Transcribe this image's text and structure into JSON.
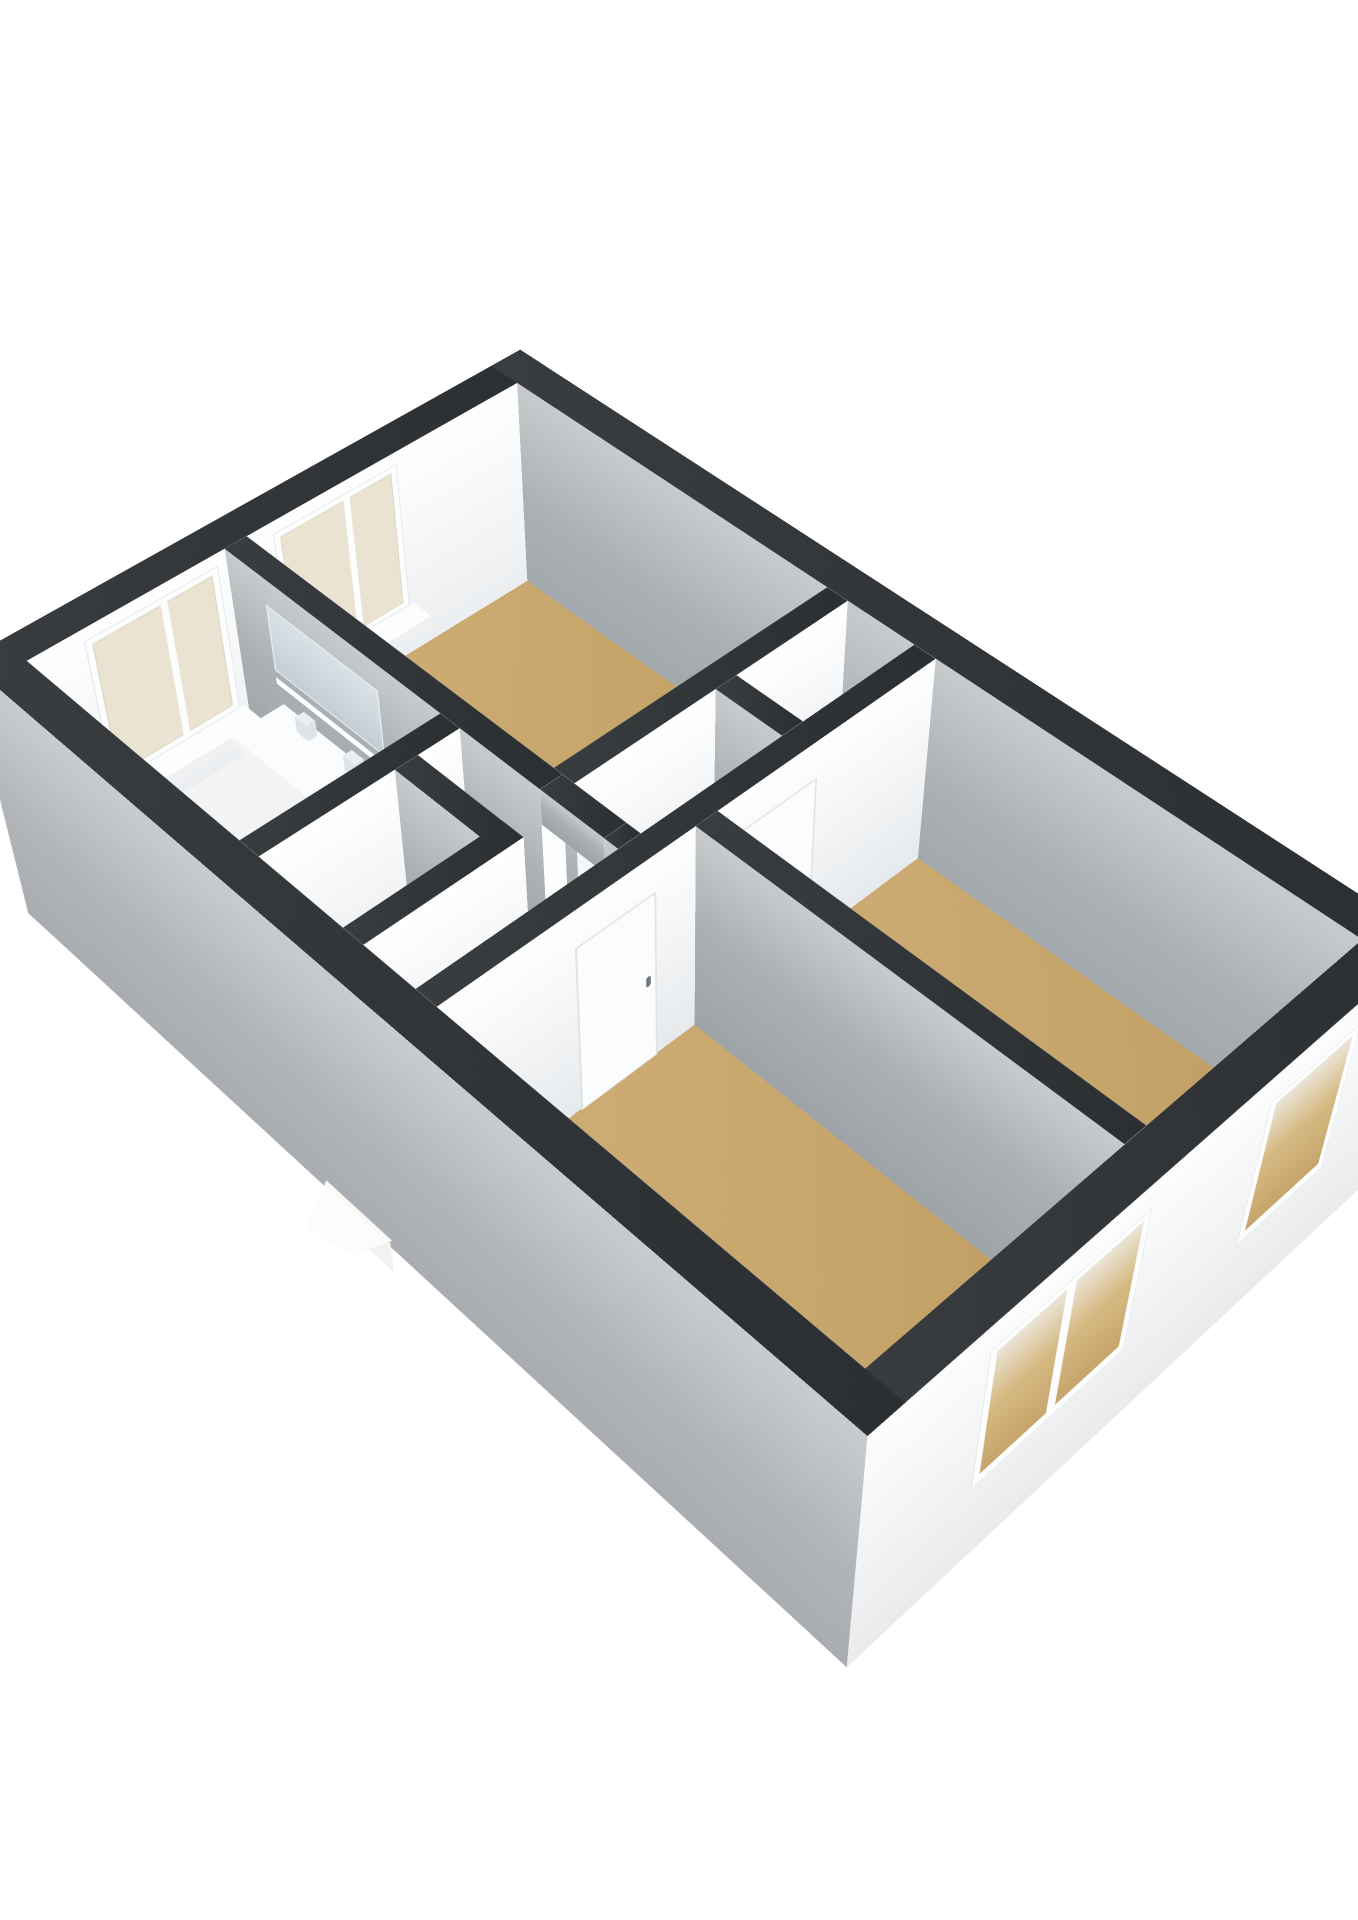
{
  "meta": {
    "kind": "3d-floorplan-render",
    "background": "#ffffff",
    "visible_text": ""
  },
  "palette": {
    "capDark": "linear-gradient(135deg,#3a3d40 0%,#2c2f32 100%)",
    "grayFace": "linear-gradient(180deg,#c7cbce 0%,#abb0b4 45%,#9ea3a7 100%)",
    "whiteFace": "linear-gradient(180deg,#ffffff 0%,#f1f3f5 55%,#e7eaec 100%)",
    "midFace": "#d5d9dc",
    "extWhite": "linear-gradient(180deg,#fdfdfe 0%,#f0f2f3 60%,#e9ebed 100%)",
    "extGray": "linear-gradient(180deg,#c9cccf 0%,#b2b5b8 55%,#a9acb0 100%)",
    "floorTan": "linear-gradient(135deg,#d0af77 0%,#c7a66c 60%,#bf9d62 100%)",
    "floorWhite": "linear-gradient(135deg,#f4f5f6 0%,#eceeef 100%)",
    "cream": "#ebe3d1",
    "frameWhite": "#fcfdfd",
    "mirror": "linear-gradient(180deg,#d8e1e6 0%,#c3ced5 100%)",
    "glassTan": "linear-gradient(180deg,#eae4d6 0%,#d6b982 45%,#c6a46c 100%)",
    "accentRed": "#cf7b7b",
    "leaf": "#fbfcfd",
    "leafEdge": "#dfe2e4",
    "handle": "#71767a"
  },
  "projection": {
    "perspective": 2800,
    "originX": "50%",
    "originY": "43%",
    "rotateX": 44,
    "rotateZ": -44,
    "scale": 1.13,
    "translate": [
      15,
      860
    ],
    "wallHeight": 240,
    "exteriorBase": -70
  },
  "building": {
    "floors": [
      {
        "name": "floor-hall-and-wet-rooms",
        "rect": [
          36,
          36,
          576,
          984
        ],
        "z": 0,
        "fill": "floorWhite"
      },
      {
        "name": "floor-bedroom-north",
        "rect": [
          264,
          36,
          576,
          430
        ],
        "z": 0.8,
        "fill": "floorTan"
      },
      {
        "name": "floor-room-front",
        "rect": [
          36,
          554,
          300,
          984
        ],
        "z": 0.8,
        "fill": "floorTan"
      },
      {
        "name": "floor-room-back",
        "rect": [
          324,
          554,
          576,
          984
        ],
        "z": 0.8,
        "fill": "floorTan"
      }
    ],
    "walls": [
      {
        "name": "exterior-wall-northwest",
        "rect": [
          0,
          0,
          612,
          36
        ],
        "z": [
          -70,
          240
        ],
        "faces": {
          "a0": "extGray",
          "a1": "extWhite",
          "b0": "extWhite",
          "b1": "whiteFace"
        }
      },
      {
        "name": "exterior-wall-northeast",
        "rect": [
          576,
          0,
          612,
          1020
        ],
        "z": [
          -70,
          240
        ],
        "faces": {
          "a0": "grayFace",
          "a1": "extWhite",
          "b0": "midFace",
          "b1": "extWhite"
        }
      },
      {
        "name": "exterior-wall-southeast",
        "rect": [
          0,
          984,
          612,
          1020
        ],
        "z": [
          -70,
          240
        ],
        "faces": {
          "a0": "extGray",
          "a1": "extWhite",
          "b0": "midFace",
          "b1": "extWhite"
        }
      },
      {
        "name": "exterior-wall-southwest",
        "rect": [
          0,
          0,
          36,
          1020
        ],
        "z": [
          -70,
          240
        ],
        "faces": {
          "a0": "extGray",
          "a1": "whiteFace",
          "b0": "extWhite",
          "b1": "extWhite"
        }
      },
      {
        "name": "wall-bathroom-east-a",
        "rect": [
          240,
          36,
          264,
          440
        ],
        "z": [
          0,
          240
        ]
      },
      {
        "name": "wall-bathroom-east-b",
        "rect": [
          240,
          514,
          264,
          530
        ],
        "z": [
          0,
          240
        ]
      },
      {
        "name": "wall-doorway-lintel",
        "rect": [
          240,
          440,
          264,
          514
        ],
        "z": [
          200,
          240
        ],
        "faces": {
          "b0": "whiteFace",
          "b1": "whiteFace"
        }
      },
      {
        "name": "wall-bathroom-south",
        "rect": [
          36,
          320,
          240,
          344
        ],
        "z": [
          0,
          240
        ]
      },
      {
        "name": "wall-wc-south",
        "rect": [
          36,
          446,
          196,
          470
        ],
        "z": [
          0,
          240
        ]
      },
      {
        "name": "wall-wc-east",
        "rect": [
          172,
          344,
          196,
          470
        ],
        "z": [
          0,
          240
        ]
      },
      {
        "name": "wall-bedroom-north-south",
        "rect": [
          264,
          430,
          576,
          454
        ],
        "z": [
          0,
          240
        ]
      },
      {
        "name": "wall-closet-west",
        "rect": [
          420,
          454,
          444,
          530
        ],
        "z": [
          0,
          240
        ]
      },
      {
        "name": "wall-corridor-south",
        "rect": [
          36,
          530,
          576,
          554
        ],
        "z": [
          0,
          240
        ]
      },
      {
        "name": "wall-rooms-divider",
        "rect": [
          300,
          554,
          324,
          984
        ],
        "z": [
          0,
          240
        ]
      }
    ],
    "windows": [
      {
        "name": "bathroom-window",
        "kind": "interior",
        "pos": 37.4,
        "a": [
          90,
          230
        ],
        "z": [
          60,
          228
        ],
        "panes": 1,
        "sill": true
      },
      {
        "name": "bedroom-north-window",
        "kind": "interior",
        "pos": 37.4,
        "a": [
          290,
          430
        ],
        "z": [
          60,
          228
        ],
        "panes": 1,
        "sill": true
      },
      {
        "name": "room-front-double-window",
        "kind": "exterior",
        "pos": 1021.6,
        "a": [
          120,
          290
        ],
        "z": [
          36,
          212
        ],
        "panes": 2,
        "sill": false
      },
      {
        "name": "room-back-window",
        "kind": "exterior",
        "pos": 1021.6,
        "a": [
          424,
          532
        ],
        "z": [
          36,
          212
        ],
        "panes": 1,
        "sill": false
      }
    ],
    "doors": [
      {
        "name": "door-to-front-room",
        "pos": 555.4,
        "a": [
          170,
          256
        ],
        "z": [
          0,
          200
        ],
        "handle": "right"
      },
      {
        "name": "door-to-back-room",
        "pos": 555.4,
        "a": [
          350,
          436
        ],
        "z": [
          0,
          200
        ],
        "handle": "left"
      }
    ],
    "fixtures": [
      {
        "type": "bplane",
        "name": "doorway-jamb-north",
        "b": 440,
        "a": [
          240,
          264
        ],
        "z": [
          0,
          200
        ],
        "fill": "frameWhite"
      },
      {
        "type": "bplane",
        "name": "doorway-jamb-south",
        "b": 514,
        "a": [
          240,
          264
        ],
        "z": [
          0,
          200
        ],
        "fill": "frameWhite"
      },
      {
        "type": "aplane",
        "name": "bathroom-mirror",
        "a": 238.4,
        "b": [
          90,
          240
        ],
        "z": [
          135,
          212
        ],
        "fill": "mirror",
        "border": "2px solid #e8eced"
      },
      {
        "type": "aplane",
        "name": "bathroom-shelf",
        "a": 238.4,
        "b": [
          90,
          240
        ],
        "z": [
          119,
          127
        ],
        "fill": "frameWhite"
      },
      {
        "type": "box",
        "name": "vanity-cabinet",
        "a": [
          186,
          240
        ],
        "b": [
          100,
          250
        ],
        "z": [
          0,
          95
        ],
        "side": "#f1f3f4",
        "cap": "#f7f8f9",
        "inset": true
      },
      {
        "type": "hplane",
        "name": "vanity-countertop",
        "a": [
          182,
          246
        ],
        "b": [
          94,
          256
        ],
        "z": 96,
        "fill": "#fbfcfd"
      },
      {
        "type": "aplane",
        "name": "vanity-counter-lip",
        "a": 182,
        "b": [
          94,
          256
        ],
        "z": [
          88,
          96
        ],
        "fill": "#f2f4f5"
      },
      {
        "type": "box",
        "name": "faucet-left",
        "a": [
          226,
          236
        ],
        "b": [
          130,
          146
        ],
        "z": [
          95,
          114
        ],
        "side": "#dfe3e6",
        "cap": "#eceff1"
      },
      {
        "type": "box",
        "name": "faucet-right",
        "a": [
          226,
          236
        ],
        "b": [
          196,
          212
        ],
        "z": [
          95,
          114
        ],
        "side": "#dfe3e6",
        "cap": "#eceff1"
      },
      {
        "type": "box",
        "name": "toilet-bowl",
        "a": [
          40,
          98
        ],
        "b": [
          376,
          434
        ],
        "z": [
          0,
          44
        ],
        "side": "#f2f4f5",
        "cap": "#fafbfc"
      },
      {
        "type": "box",
        "name": "toilet-tank",
        "a": [
          38,
          58
        ],
        "b": [
          382,
          428
        ],
        "z": [
          0,
          62
        ],
        "side": "#eef1f2",
        "cap": "#f8fafa"
      },
      {
        "type": "mixer",
        "name": "shower-mixer-fixture",
        "b": 37.6,
        "a": [
          56,
          84
        ],
        "z": [
          88,
          140
        ]
      },
      {
        "type": "wedgeTop",
        "name": "exterior-door-below-top",
        "a": [
          -42,
          0
        ],
        "b": [
          428,
          512
        ],
        "z": -58,
        "fill": "#fcfcfb"
      },
      {
        "type": "wedgeSide",
        "name": "exterior-door-below-side",
        "a": -2,
        "b": [
          428,
          512
        ],
        "z": [
          -100,
          -58
        ],
        "fill": "#f2f2f0"
      }
    ]
  }
}
